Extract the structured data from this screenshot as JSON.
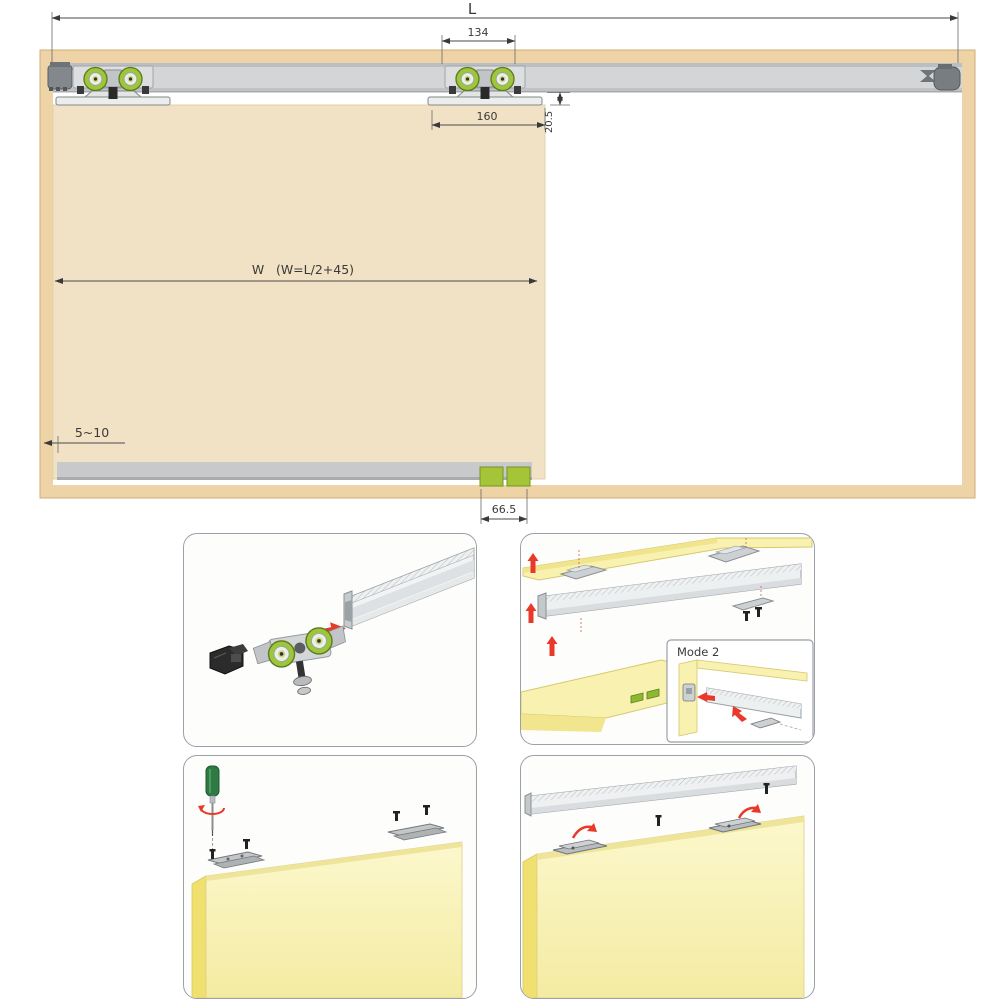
{
  "top_diagram": {
    "dims": {
      "overall_length": "L",
      "hanger_spacing": "134",
      "bracket_length": "160",
      "track_to_door_gap": "20.5",
      "door_width_label": "W",
      "door_width_formula": "(W=L/2+45)",
      "side_clearance": "5~10",
      "floor_guide_width": "66.5"
    }
  },
  "install_steps": {
    "mode2_label": "Mode 2"
  },
  "colors": {
    "frame_wood": "#edd3a6",
    "door_panel": "#f2e2c5",
    "track_gray": "#d3d5d7",
    "roller_green": "#9dc63c",
    "floor_guide_green": "#a5c438",
    "step_panel_yellow": "#f8f1af",
    "arrow_red": "#e8392b"
  }
}
